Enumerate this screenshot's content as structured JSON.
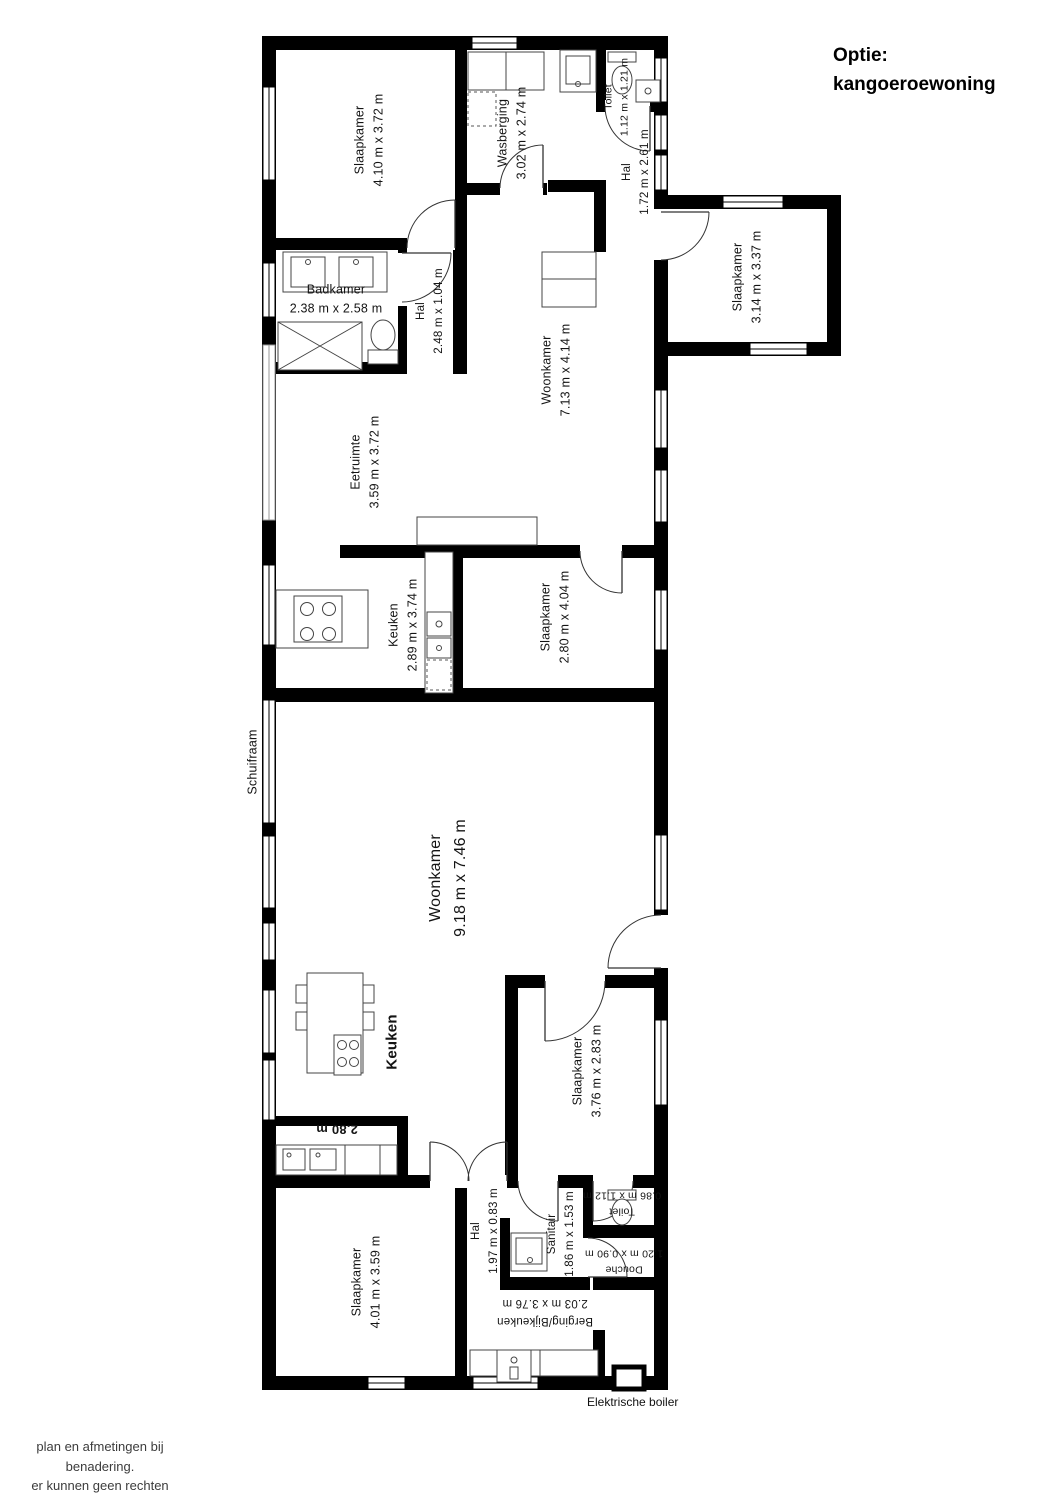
{
  "title": {
    "line1": "Optie:",
    "line2": "kangoeroewoning"
  },
  "rooms": [
    {
      "id": "slaapkamer-1",
      "name": "Slaapkamer",
      "dims": "4.10 m x 3.72 m"
    },
    {
      "id": "wasberging",
      "name": "Wasberging",
      "dims": "3.02 m x 2.74 m"
    },
    {
      "id": "toilet-boven",
      "name": "Toilet",
      "dims": "1.12 m x 1.21 m"
    },
    {
      "id": "hal-boven",
      "name": "Hal",
      "dims": "1.72 m x 2.61 m"
    },
    {
      "id": "slaapkamer-2",
      "name": "Slaapkamer",
      "dims": "3.14 m x 3.37 m"
    },
    {
      "id": "badkamer",
      "name": "Badkamer",
      "dims": "2.38 m x 2.58 m"
    },
    {
      "id": "hal-badkamer",
      "name": "Hal",
      "dims": "2.48 m x 1.04 m"
    },
    {
      "id": "woonkamer-boven",
      "name": "Woonkamer",
      "dims": "7.13 m x 4.14 m"
    },
    {
      "id": "eetruimte",
      "name": "Eetruimte",
      "dims": "3.59 m x 3.72 m"
    },
    {
      "id": "keuken-boven",
      "name": "Keuken",
      "dims": "2.89 m x 3.74 m"
    },
    {
      "id": "slaapkamer-3",
      "name": "Slaapkamer",
      "dims": "2.80 m x 4.04 m"
    },
    {
      "id": "woonkamer-beneden",
      "name": "Woonkamer",
      "dims": "9.18 m x 7.46 m"
    },
    {
      "id": "keuken-beneden",
      "name": "Keuken",
      "dims": ""
    },
    {
      "id": "slaapkamer-4",
      "name": "Slaapkamer",
      "dims": "3.76 m x 2.83 m"
    },
    {
      "id": "slaapkamer-5",
      "name": "Slaapkamer",
      "dims": "4.01 m x 3.59 m"
    },
    {
      "id": "hal-beneden",
      "name": "Hal",
      "dims": "1.97 m x 0.83 m"
    },
    {
      "id": "sanitair",
      "name": "Sanitair",
      "dims": "1.86 m x 1.53 m"
    },
    {
      "id": "toilet-beneden",
      "name": "Toilet",
      "dims": "0.86 m x 1.12 m"
    },
    {
      "id": "douche",
      "name": "Douche",
      "dims": "1.20 m x 0.90 m"
    },
    {
      "id": "berging",
      "name": "Berging/Bijkeuken",
      "dims": "2.03 m x 3.76 m"
    }
  ],
  "annotations": {
    "schuifraam": "Schuifraam",
    "counter_width": "2.80 m",
    "boiler": "Elektrische boiler"
  },
  "footer": {
    "lines": [
      "plan en afmetingen bij benadering.",
      "er kunnen geen rechten ontleend",
      "worden aan dit plan.",
      "copyright Frame 24"
    ]
  },
  "colors": {
    "wall": "#000000",
    "fixture": "#444444",
    "open_wall": "#9a9a9a",
    "text": "#141414"
  }
}
